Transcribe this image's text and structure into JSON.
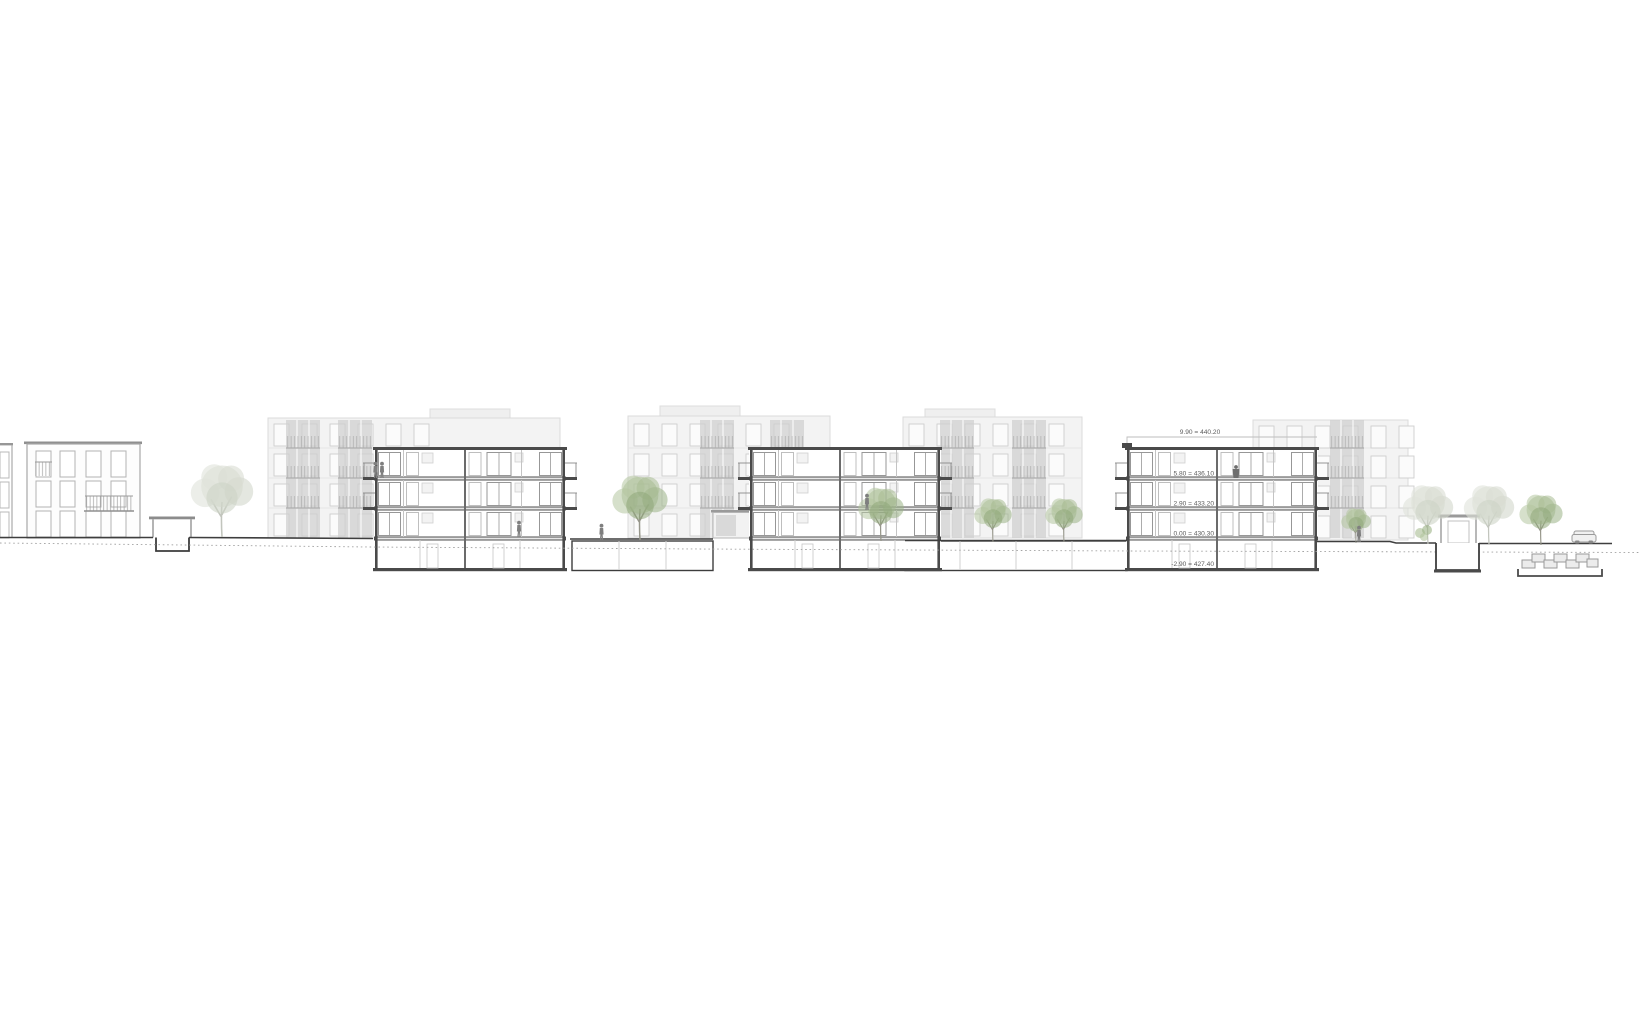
{
  "drawing": {
    "type": "architectural longitudinal site section",
    "subject": "residential buildings cross-section with courtyards, trees and underground garage"
  },
  "annotations": {
    "roof_parapet": "9.90 = 440.20",
    "level_3": "5.80 = 436.10",
    "level_2": "2.90 = 433.20",
    "level_ground": "0.00 = 430.30",
    "level_basement": "-2.90 = 427.40"
  },
  "palette": {
    "background": "#ffffff",
    "cut_line": "#3d3d3d",
    "mid_line": "#9a9a9a",
    "light_line": "#c9c9c9",
    "glazing_gray": "#c6c6c6",
    "tree_green": "#a8bc92",
    "tree_pale": "#d6dad1",
    "figure_gray": "#7f7f7f"
  }
}
